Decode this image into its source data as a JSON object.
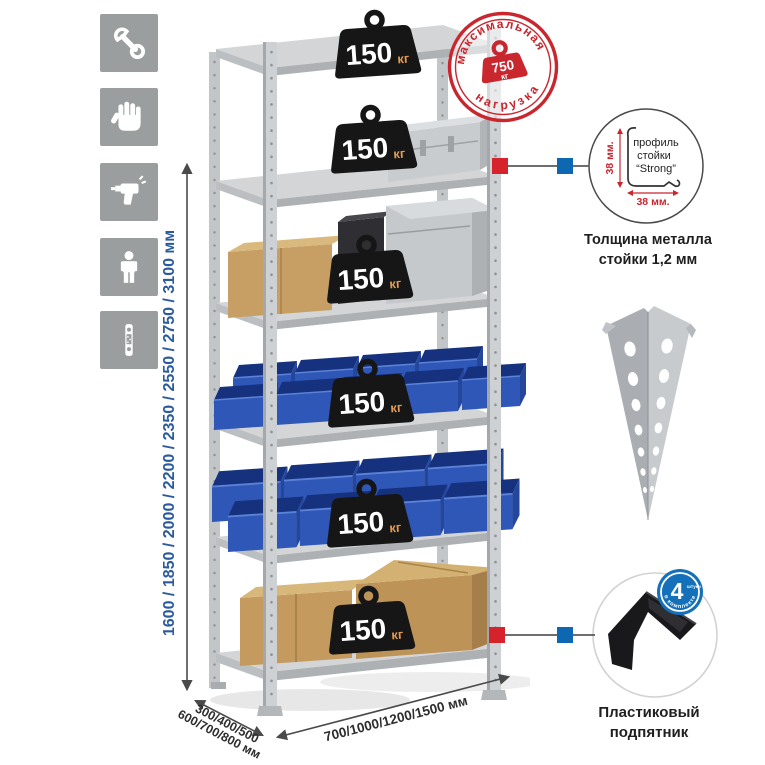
{
  "left_icons": [
    {
      "name": "wrench-icon"
    },
    {
      "name": "gloves-icon"
    },
    {
      "name": "drill-icon"
    },
    {
      "name": "person-icon"
    },
    {
      "name": "post-profile-icon"
    }
  ],
  "dimensions": {
    "height_label": "1600 / 1850 / 2000 / 2200 / 2350 / 2550 / 2750 / 3100 мм",
    "depth_label_line1": "300/400/500",
    "depth_label_line2": "600/700/800 мм",
    "width_label": "700/1000/1200/1500 мм",
    "text_color": "#2b5b9e"
  },
  "rack": {
    "shelf_loads": [
      {
        "value": "150",
        "unit": "кг"
      },
      {
        "value": "150",
        "unit": "кг"
      },
      {
        "value": "150",
        "unit": "кг"
      },
      {
        "value": "150",
        "unit": "кг"
      },
      {
        "value": "150",
        "unit": "кг"
      },
      {
        "value": "150",
        "unit": "кг"
      }
    ]
  },
  "max_load_stamp": {
    "arc_top": "максимальная",
    "arc_bottom": "нагрузка",
    "value": "750",
    "unit": "кг",
    "color": "#c9262e"
  },
  "profile_detail": {
    "label_line1": "профиль",
    "label_line2": "стойки",
    "label_line3": "“Strong”",
    "dim_vertical": "38 мм.",
    "dim_horizontal": "38 мм.",
    "caption_line1": "Толщина металла",
    "caption_line2": "стойки 1,2 мм"
  },
  "foot_detail": {
    "badge_number": "4",
    "badge_word": "штуки",
    "badge_arc": "в комплекте",
    "caption_line1": "Пластиковый",
    "caption_line2": "подпятник"
  },
  "connectors": {
    "red": "#d6232b",
    "blue": "#0e67b1"
  }
}
